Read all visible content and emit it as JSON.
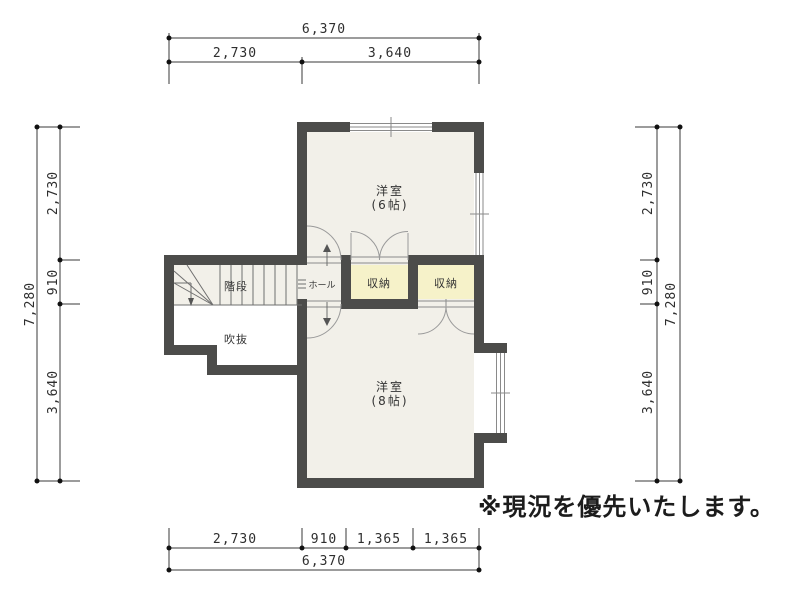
{
  "rooms": {
    "western6": {
      "name": "洋室",
      "size": "(6帖)"
    },
    "western8": {
      "name": "洋室",
      "size": "(8帖)"
    },
    "closet_left": {
      "name": "収納"
    },
    "closet_right": {
      "name": "収納"
    },
    "stairs": {
      "name": "階段"
    },
    "hall": {
      "name": "ホール"
    },
    "void": {
      "name": "吹抜"
    }
  },
  "note": "※現況を優先いたします。",
  "dimensions": {
    "top": {
      "total": "6,370",
      "segments": [
        "2,730",
        "3,640"
      ]
    },
    "bottom": {
      "total": "6,370",
      "segments": [
        "2,730",
        "910",
        "1,365",
        "1,365"
      ]
    },
    "left": {
      "total": "7,280",
      "segments": [
        "2,730",
        "910",
        "3,640"
      ]
    },
    "right": {
      "total": "7,280",
      "segments": [
        "2,730",
        "910",
        "3,640"
      ]
    }
  },
  "colors": {
    "wall": "#4c4c4a",
    "floor": "#f2f0e9",
    "closet": "#f6f2c9",
    "background": "#ffffff",
    "dimension_line": "#3a3a3a"
  }
}
